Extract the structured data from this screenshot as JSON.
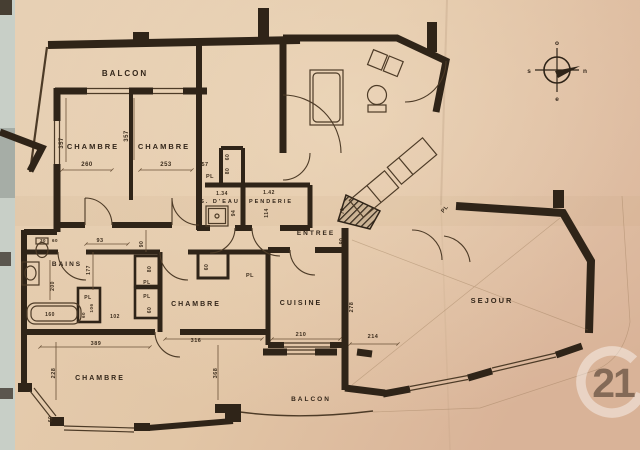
{
  "title": "apartment floor plan scan",
  "palette": {
    "paper": "#e4cbae",
    "paper_right": "#dcb79c",
    "ink": "#2f2418",
    "scan_strip": "#c8cfc7",
    "watermark_white": "#ffffff"
  },
  "rooms": {
    "balcon_top": "BALCON",
    "chambre_nw": "CHAMBRE",
    "chambre_n": "CHAMBRE",
    "sdeau": "S. D'EAU",
    "penderie": "PENDERIE",
    "entree": "ENTREE",
    "bains": "BAINS",
    "chambre_mid": "CHAMBRE",
    "cuisine": "CUISINE",
    "sejour": "SEJOUR",
    "chambre_sw": "CHAMBRE",
    "balcon_bottom": "BALCON"
  },
  "closet_label": "PL",
  "dims": {
    "d357a": "357",
    "d260": "260",
    "d357b": "357",
    "d253": "253",
    "d57": "57",
    "d60_pl_top": "60",
    "d80_pl_top": "80",
    "d134": "1.34",
    "d94": "94",
    "d142": "1.42",
    "d114": "114",
    "d70": "70",
    "d90_entree": "90",
    "d93": "93",
    "d177": "177",
    "d90_hall": "90",
    "d30": "30",
    "d60_wc": "60",
    "d200": "200",
    "d160": "160",
    "d106": "106",
    "d60_left": "60",
    "d102": "102",
    "d80_mid": "80",
    "d60_mid": "60",
    "d60_closet": "60",
    "d316": "316",
    "d210": "210",
    "d278": "278",
    "d214": "214",
    "d389": "389",
    "d228": "228",
    "d368": "368",
    "d60_bay": "60"
  },
  "compass": {
    "top": "o",
    "right": "n",
    "left": "s",
    "bottom": "e"
  },
  "watermark": {
    "text": "21"
  }
}
